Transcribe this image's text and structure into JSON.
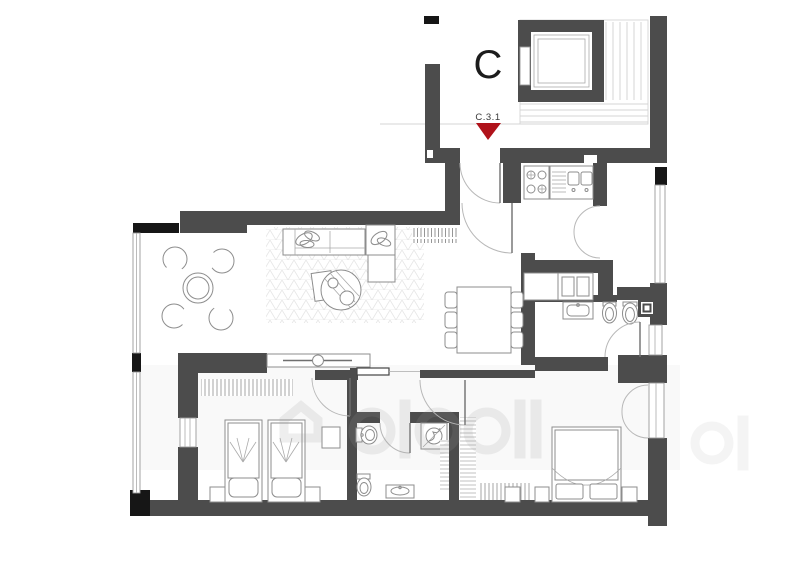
{
  "plan": {
    "building_label": "C",
    "unit_marker": {
      "label": "C.3.1"
    }
  },
  "watermark": {
    "visible": true,
    "legible": false
  },
  "colors": {
    "wall_gray": "#4C4C4C",
    "black": "#161616",
    "marker_red": "#B0121A",
    "furniture_line": "#8D8D8D",
    "stair_line": "#D4D4D4"
  }
}
